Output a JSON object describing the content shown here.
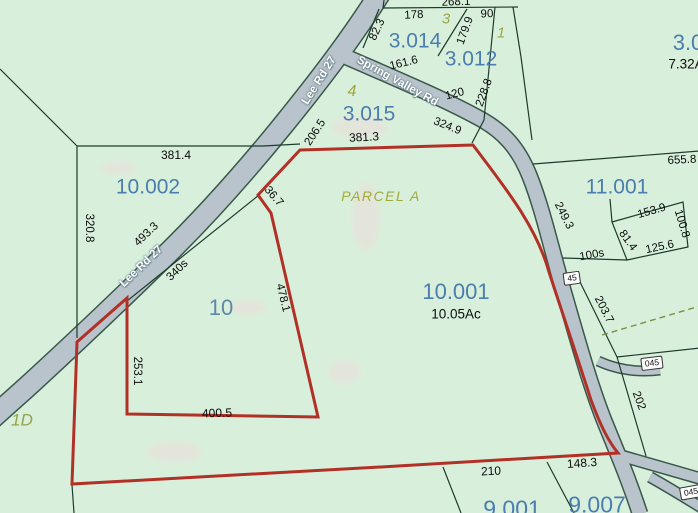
{
  "map": {
    "colors": {
      "background": "#d8f0db",
      "road": "#b8c3cb",
      "road_edge": "#39584a",
      "boundary": "#1c3b2b",
      "highlight_boundary": "#b23127",
      "parcel_number": "#4b7dae",
      "zone_label": "#9da63c",
      "dimension_text": "#0b0b0b",
      "dashed_line": "#7d8d3e"
    },
    "parcel_numbers": [
      {
        "t": "10.002",
        "x": 148,
        "y": 187
      },
      {
        "t": "3.014",
        "x": 415,
        "y": 41
      },
      {
        "t": "3.012",
        "x": 471,
        "y": 59
      },
      {
        "t": "3.015",
        "x": 369,
        "y": 114
      },
      {
        "t": "10.001",
        "x": 456,
        "y": 292,
        "s": 22
      },
      {
        "t": "11.001",
        "x": 617,
        "y": 187
      },
      {
        "t": "3.0",
        "x": 688,
        "y": 43,
        "s": 22
      },
      {
        "t": "9.001",
        "x": 512,
        "y": 509,
        "s": 23
      },
      {
        "t": "9.007",
        "x": 597,
        "y": 505,
        "s": 23
      },
      {
        "t": "10",
        "x": 221,
        "y": 308,
        "s": 22,
        "c": "#5d89a6"
      }
    ],
    "zone_labels": [
      {
        "t": "3",
        "x": 446,
        "y": 19,
        "s": 15
      },
      {
        "t": "1",
        "x": 501,
        "y": 33,
        "s": 15
      },
      {
        "t": "4",
        "x": 352,
        "y": 92,
        "s": 16
      },
      {
        "t": "PARCEL A",
        "x": 381,
        "y": 196,
        "s": 14,
        "ls": 1.5,
        "c": "#a2aa3c"
      },
      {
        "t": "1D",
        "x": 22,
        "y": 420,
        "s": 17,
        "c": "#94a249"
      }
    ],
    "dimensions": [
      {
        "t": "268.1",
        "x": 456,
        "y": 3,
        "r": -2
      },
      {
        "t": "178",
        "x": 414,
        "y": 16,
        "r": -3
      },
      {
        "t": "90",
        "x": 487,
        "y": 15,
        "r": -2
      },
      {
        "t": "82.3",
        "x": 378,
        "y": 30,
        "r": -65
      },
      {
        "t": "179.9",
        "x": 466,
        "y": 31,
        "r": -70
      },
      {
        "t": "161.6",
        "x": 404,
        "y": 64,
        "r": -14
      },
      {
        "t": "120",
        "x": 455,
        "y": 95,
        "r": -15
      },
      {
        "t": "228.8",
        "x": 485,
        "y": 93,
        "r": -70
      },
      {
        "t": "206.5",
        "x": 316,
        "y": 133,
        "r": -57
      },
      {
        "t": "381.3",
        "x": 364,
        "y": 137,
        "r": -3,
        "s": 12
      },
      {
        "t": "324.9",
        "x": 447,
        "y": 127,
        "r": 22
      },
      {
        "t": "381.4",
        "x": 176,
        "y": 155,
        "r": 0,
        "s": 12
      },
      {
        "t": "320.8",
        "x": 88,
        "y": 228,
        "r": 90
      },
      {
        "t": "493.3",
        "x": 147,
        "y": 235,
        "r": -44
      },
      {
        "t": "340s",
        "x": 178,
        "y": 271,
        "r": -44
      },
      {
        "t": "36.7",
        "x": 273,
        "y": 197,
        "r": 49
      },
      {
        "t": "478.1",
        "x": 282,
        "y": 298,
        "r": 76
      },
      {
        "t": "253.1",
        "x": 136,
        "y": 371,
        "r": 90
      },
      {
        "t": "400.5",
        "x": 217,
        "y": 413,
        "r": -2,
        "s": 12
      },
      {
        "t": "655.8",
        "x": 682,
        "y": 161,
        "r": -3
      },
      {
        "t": "249.3",
        "x": 563,
        "y": 216,
        "r": 63
      },
      {
        "t": "153.9",
        "x": 652,
        "y": 212,
        "r": -16
      },
      {
        "t": "100.8",
        "x": 681,
        "y": 224,
        "r": 73
      },
      {
        "t": "81.4",
        "x": 627,
        "y": 241,
        "r": 54
      },
      {
        "t": "125.6",
        "x": 660,
        "y": 248,
        "r": -12
      },
      {
        "t": "100s",
        "x": 592,
        "y": 256,
        "r": -10
      },
      {
        "t": "203.7",
        "x": 603,
        "y": 310,
        "r": 63
      },
      {
        "t": "202",
        "x": 638,
        "y": 401,
        "r": 69
      },
      {
        "t": "210",
        "x": 491,
        "y": 471,
        "r": -3,
        "s": 12
      },
      {
        "t": "148.3",
        "x": 582,
        "y": 463,
        "r": -4,
        "s": 12
      }
    ],
    "area_labels": [
      {
        "t": "10.05Ac",
        "x": 456,
        "y": 314
      },
      {
        "t": "7.32A",
        "x": 686,
        "y": 64
      }
    ],
    "road_labels": [
      {
        "t": "Lee Rd 27",
        "x": 320,
        "y": 81,
        "r": -58
      },
      {
        "t": "Spring Valley Rd",
        "x": 397,
        "y": 82,
        "r": 29
      },
      {
        "t": "Lee Rd 27",
        "x": 142,
        "y": 267,
        "r": -44
      }
    ],
    "route_shields": [
      {
        "t": "45",
        "x": 572,
        "y": 278,
        "r": -8
      },
      {
        "t": "045",
        "x": 652,
        "y": 363,
        "r": -7
      },
      {
        "t": "045",
        "x": 691,
        "y": 492,
        "r": -10
      }
    ]
  }
}
